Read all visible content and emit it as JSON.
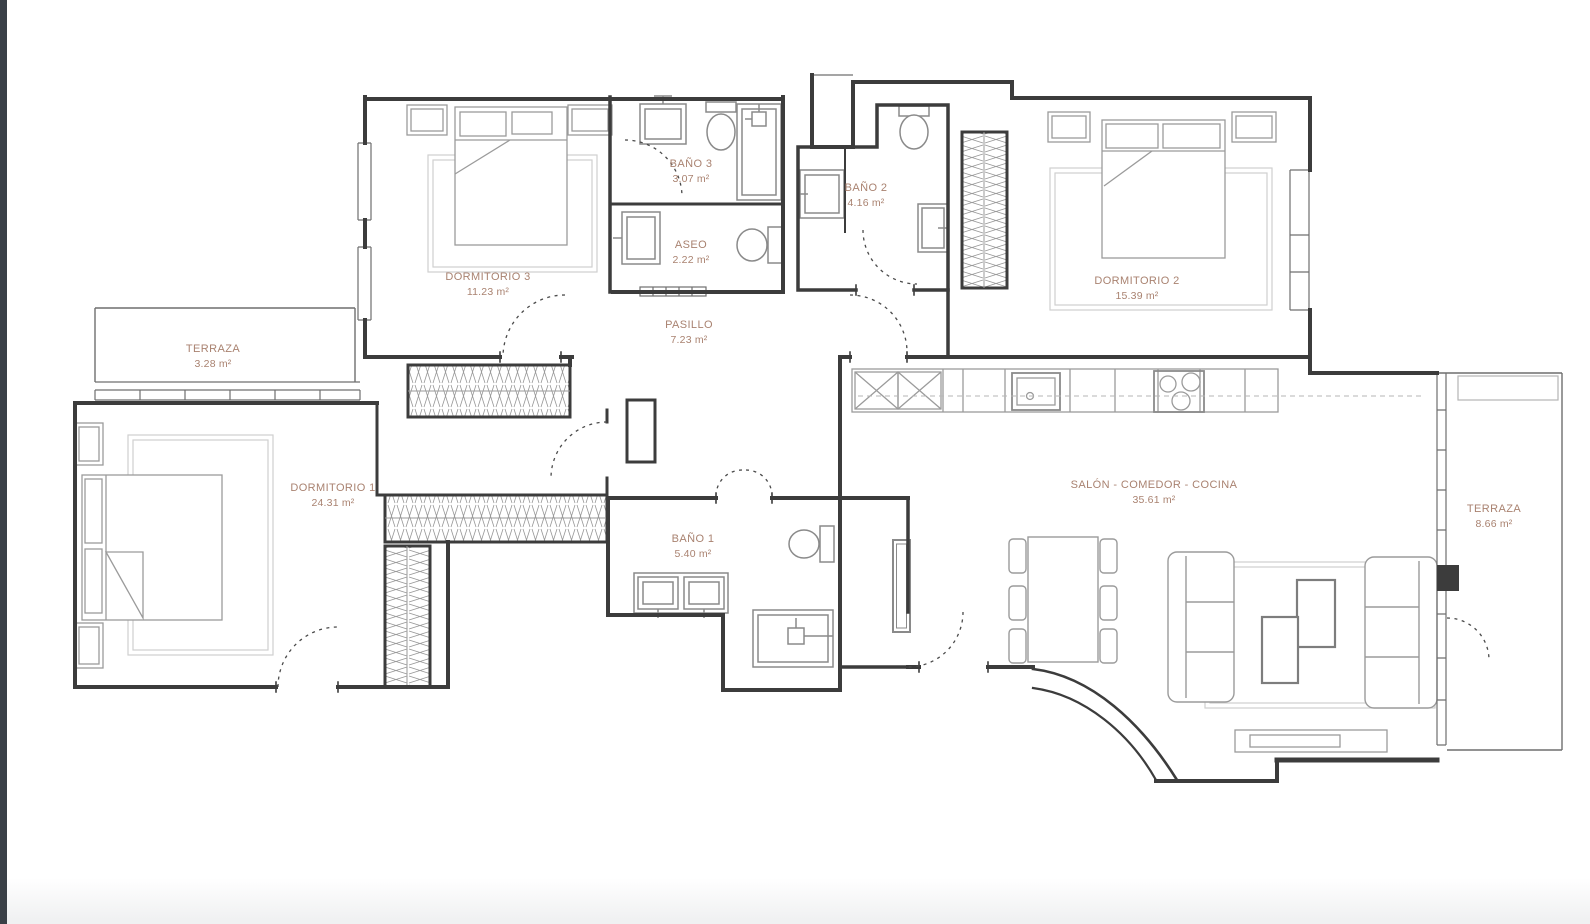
{
  "page": {
    "background": "#ffffff",
    "left_edge_bar_color": "#3a4047",
    "bottom_fade_color": "#f0f1f2"
  },
  "plan": {
    "label_color": "#a98270",
    "wall_color": "#3c3c3c",
    "furniture_color": "#9b9b9b",
    "rooms": [
      {
        "id": "dormitorio-3",
        "name": "DORMITORIO 3",
        "area": "11.23 m²"
      },
      {
        "id": "bano-3",
        "name": "BAÑO 3",
        "area": "3.07 m²"
      },
      {
        "id": "aseo",
        "name": "ASEO",
        "area": "2.22 m²"
      },
      {
        "id": "bano-2",
        "name": "BAÑO 2",
        "area": "4.16 m²"
      },
      {
        "id": "dormitorio-2",
        "name": "DORMITORIO 2",
        "area": "15.39 m²"
      },
      {
        "id": "pasillo",
        "name": "PASILLO",
        "area": "7.23 m²"
      },
      {
        "id": "terraza-izquierda",
        "name": "TERRAZA",
        "area": "3.28 m²"
      },
      {
        "id": "dormitorio-1",
        "name": "DORMITORIO 1",
        "area": "24.31 m²"
      },
      {
        "id": "bano-1",
        "name": "BAÑO 1",
        "area": "5.40 m²"
      },
      {
        "id": "salon",
        "name": "SALÓN - COMEDOR - COCINA",
        "area": "35.61 m²"
      },
      {
        "id": "terraza-derecha",
        "name": "TERRAZA",
        "area": "8.66 m²"
      }
    ]
  }
}
